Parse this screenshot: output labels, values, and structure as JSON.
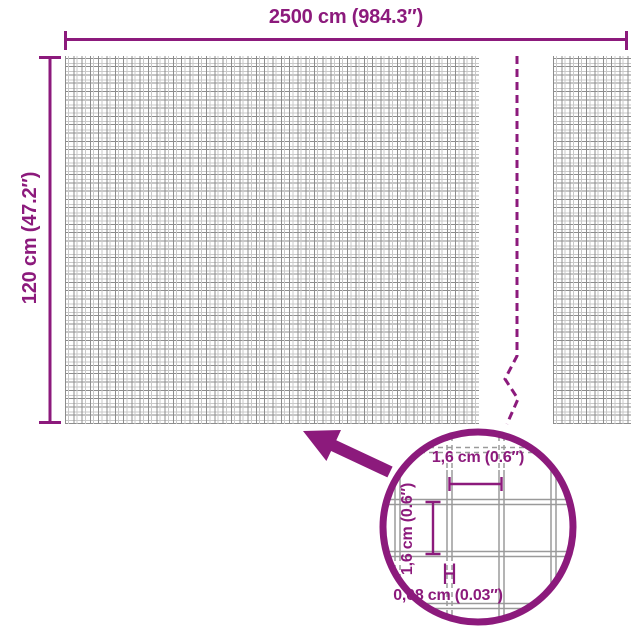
{
  "colors": {
    "accent": "#8c1a7c",
    "grid_line": "#8d8d8d",
    "grid_line_light": "#c9c9c9",
    "magnifier_wire": "#9a9a9a",
    "background": "#ffffff"
  },
  "diagram": {
    "width_dimension": "2500 cm (984.3″)",
    "height_dimension": "120 cm (47.2″)"
  },
  "magnifier": {
    "cell_width": "1,6 cm (0.6″)",
    "cell_height": "1,6 cm (0.6″)",
    "wire_thickness": "0,08 cm (0.03″)"
  }
}
